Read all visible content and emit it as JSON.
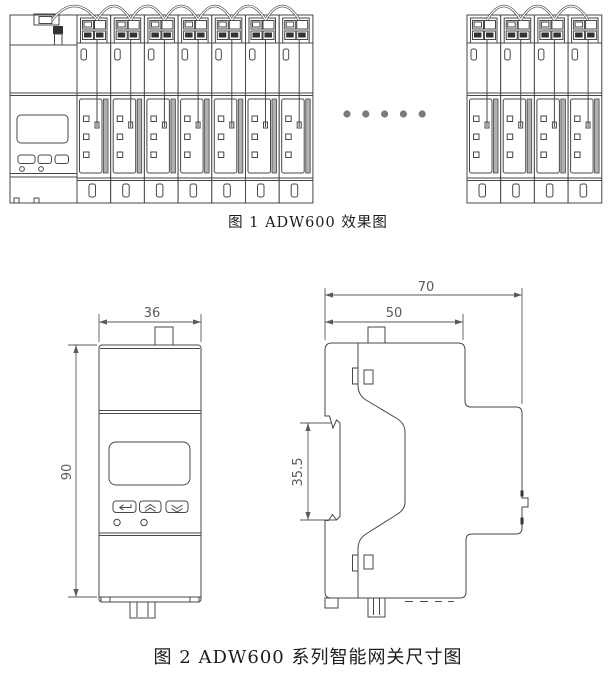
{
  "colors": {
    "background": "#ffffff",
    "line": "#474747",
    "dimension": "#5a5a5a",
    "caption_text": "#1c1c1c",
    "ellipsis_dot": "#7a7a7a",
    "panel_strip": "#b0b0b0",
    "connector_black": "#1b1b1b"
  },
  "figure1": {
    "caption": "图 1 ADW600 效果图",
    "gateway": {
      "display": "lcd-screen",
      "buttons": [
        "enter",
        "up",
        "down"
      ],
      "led_count": 2
    },
    "left_module_count": 7,
    "right_module_count": 4,
    "ellipsis_dot_count": 5
  },
  "figure2": {
    "caption": "图 2 ADW600 系列智能网关尺寸图",
    "front_view": {
      "width_mm": "36",
      "height_mm": "90",
      "buttons": [
        "enter",
        "up",
        "down"
      ],
      "led_count": 2
    },
    "side_view": {
      "overall_depth_mm": "70",
      "upper_depth_mm": "50",
      "din_rail_mm": "35.5"
    }
  }
}
